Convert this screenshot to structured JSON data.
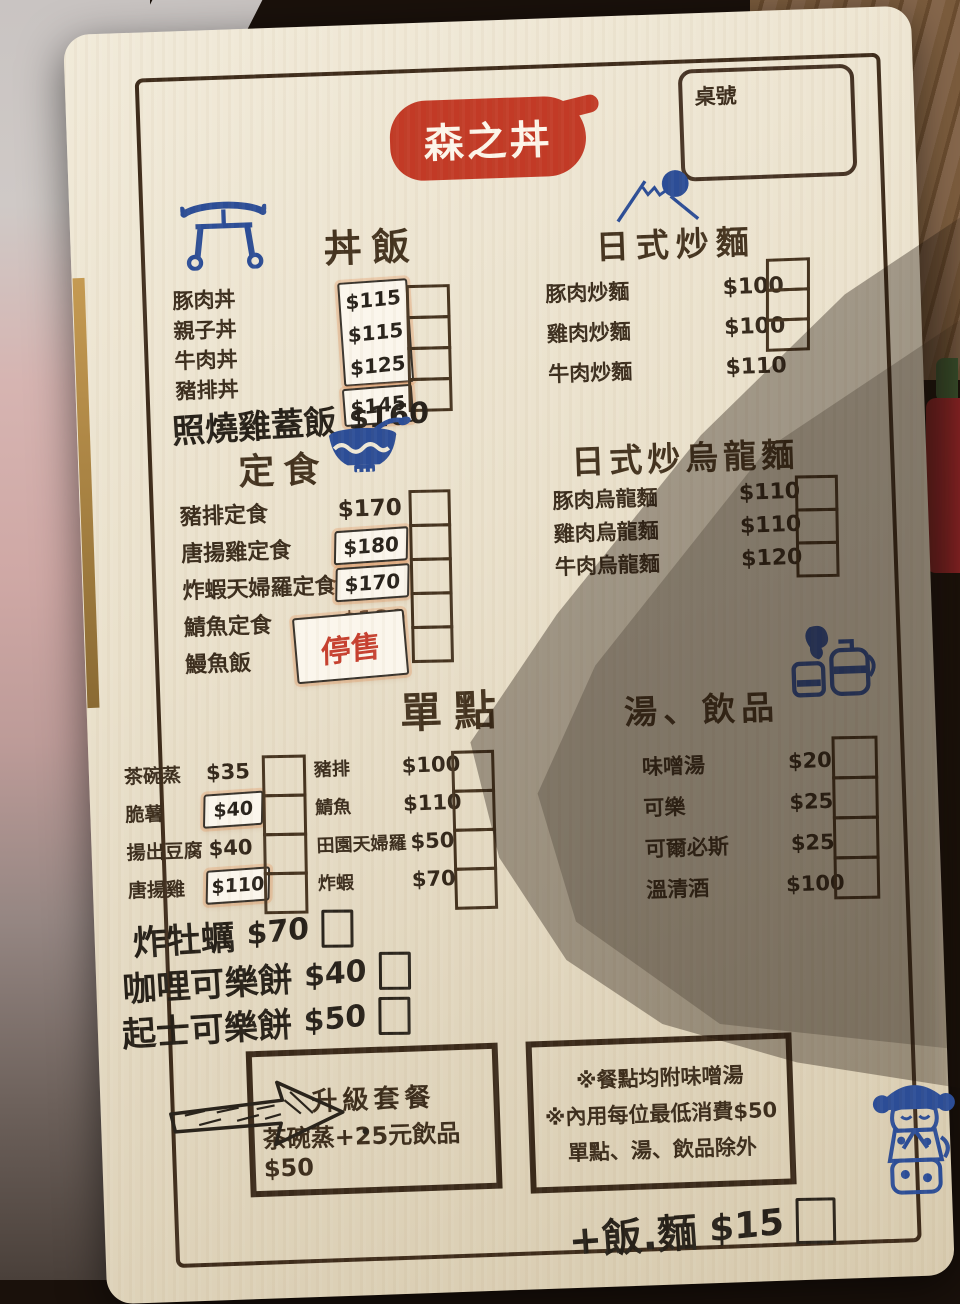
{
  "logo": {
    "text": "森之丼"
  },
  "table_box": {
    "label": "桌號"
  },
  "menu": {
    "donburi": {
      "title": "丼飯",
      "items": [
        {
          "name": "豚肉丼",
          "price": "$115"
        },
        {
          "name": "親子丼",
          "price": "$115"
        },
        {
          "name": "牛肉丼",
          "price": "$125"
        },
        {
          "name": "豬排丼",
          "price": "$145"
        }
      ],
      "extra_item": {
        "name": "照燒雞蓋飯",
        "price": "$160"
      }
    },
    "teishoku": {
      "title": "定食",
      "items": [
        {
          "name": "豬排定食",
          "price": "$170"
        },
        {
          "name": "唐揚雞定食",
          "price": "$180"
        },
        {
          "name": "炸蝦天婦羅定食",
          "price": "$170"
        },
        {
          "name": "鯖魚定食",
          "price": "$180"
        },
        {
          "name": "鰻魚飯",
          "price": "停售"
        }
      ]
    },
    "yakisoba": {
      "title": "日式炒麵",
      "items": [
        {
          "name": "豚肉炒麵",
          "price": "$100"
        },
        {
          "name": "雞肉炒麵",
          "price": "$100"
        },
        {
          "name": "牛肉炒麵",
          "price": "$110"
        }
      ]
    },
    "udon": {
      "title": "日式炒烏龍麵",
      "items": [
        {
          "name": "豚肉烏龍麵",
          "price": "$110"
        },
        {
          "name": "雞肉烏龍麵",
          "price": "$110"
        },
        {
          "name": "牛肉烏龍麵",
          "price": "$120"
        }
      ]
    },
    "single": {
      "title": "單點",
      "col_a": [
        {
          "name": "茶碗蒸",
          "price": "$35"
        },
        {
          "name": "脆薯",
          "price": "$40"
        },
        {
          "name": "揚出豆腐",
          "price": "$40"
        },
        {
          "name": "唐揚雞",
          "price": "$110"
        }
      ],
      "col_b": [
        {
          "name": "豬排",
          "price": "$100"
        },
        {
          "name": "鯖魚",
          "price": "$110"
        },
        {
          "name": "田園天婦羅",
          "price": "$50"
        },
        {
          "name": "炸蝦",
          "price": "$70"
        }
      ],
      "handwritten": [
        {
          "name": "炸牡蠣",
          "price": "$70"
        },
        {
          "name": "咖哩可樂餅",
          "price": "$40"
        },
        {
          "name": "起士可樂餅",
          "price": "$50"
        }
      ]
    },
    "soup_drinks": {
      "title": "湯、飲品",
      "items": [
        {
          "name": "味噌湯",
          "price": "$20"
        },
        {
          "name": "可樂",
          "price": "$25"
        },
        {
          "name": "可爾必斯",
          "price": "$25"
        },
        {
          "name": "溫清酒",
          "price": "$100"
        }
      ]
    }
  },
  "upgrade_box": {
    "title": "升級套餐",
    "text": "茶碗蒸+25元飲品$50"
  },
  "notes_box": {
    "lines": [
      "※餐點均附味噌湯",
      "※內用每位最低消費$50",
      "單點、湯、飲品除外"
    ]
  },
  "bottom_note": {
    "name": "+飯.麵",
    "price": "$15"
  },
  "icons": {
    "donburi": "torii-gate-icon",
    "teishoku": "rice-bowl-icon",
    "yakisoba": "mount-fuji-icon",
    "soup_drinks": "sake-set-icon",
    "upgrade": "hand-drawn-arrow-icon",
    "footer": "kokeshi-doll-icon"
  },
  "colors": {
    "logo_red": "#c23a26",
    "icon_blue": "#2c4d96",
    "ink_brown": "#3e2c1b",
    "sold_out_red": "#c6402f",
    "board_cream": "#ece3cf"
  }
}
